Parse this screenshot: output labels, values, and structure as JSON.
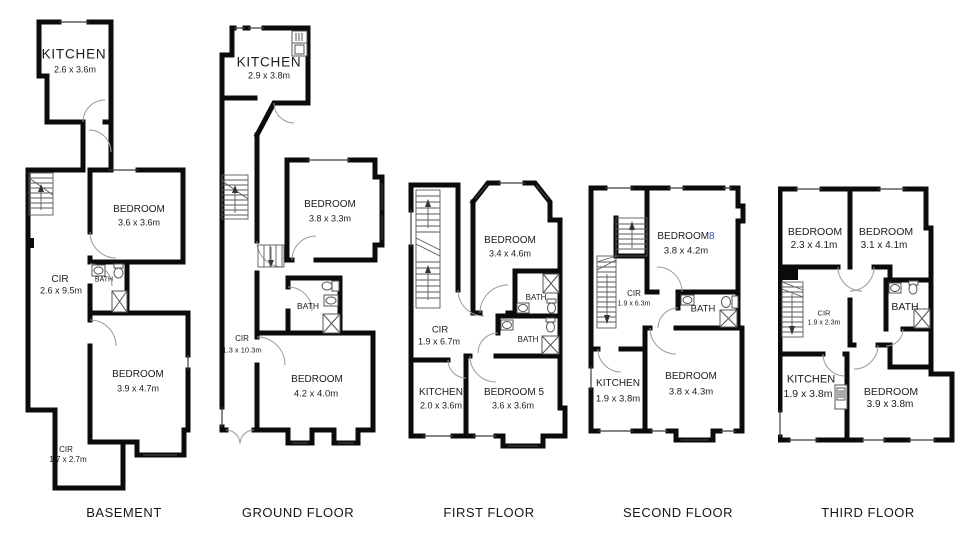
{
  "colors": {
    "wall": "#0b0b0b",
    "text": "#1c1c1e",
    "accent_number": "#3b52c3"
  },
  "floors": [
    {
      "caption": "BASEMENT",
      "rooms": [
        {
          "name": "KITCHEN",
          "dims": "2.6 x 3.6m"
        },
        {
          "name": "BEDROOM",
          "dims": "3.6 x 3.6m"
        },
        {
          "name": "CIR",
          "dims": "2.6 x 9.5m"
        },
        {
          "name": "BATH"
        },
        {
          "name": "BEDROOM",
          "dims": "3.9 x 4.7m"
        },
        {
          "name": "CIR",
          "dims": "1.7 x 2.7m"
        }
      ]
    },
    {
      "caption": "GROUND FLOOR",
      "rooms": [
        {
          "name": "KITCHEN",
          "dims": "2.9 x 3.8m"
        },
        {
          "name": "BEDROOM",
          "dims": "3.8 x 3.3m"
        },
        {
          "name": "BATH"
        },
        {
          "name": "CIR",
          "dims": "1.3 x 10.3m"
        },
        {
          "name": "BEDROOM",
          "dims": "4.2 x 4.0m"
        }
      ]
    },
    {
      "caption": "FIRST FLOOR",
      "rooms": [
        {
          "name": "BEDROOM",
          "dims": "3.4 x 4.6m"
        },
        {
          "name": "BATH"
        },
        {
          "name": "BATH"
        },
        {
          "name": "CIR",
          "dims": "1.9 x 6.7m"
        },
        {
          "name": "KITCHEN",
          "dims": "2.0 x 3.6m"
        },
        {
          "name": "BEDROOM 5",
          "dims": "3.6 x 3.6m"
        }
      ]
    },
    {
      "caption": "SECOND FLOOR",
      "rooms": [
        {
          "name": "BEDROOM",
          "suffix": "8",
          "dims": "3.8 x 4.2m"
        },
        {
          "name": "CIR",
          "dims": "1.9 x 6.3m"
        },
        {
          "name": "BATH"
        },
        {
          "name": "KITCHEN",
          "dims": "1.9 x 3.8m"
        },
        {
          "name": "BEDROOM",
          "dims": "3.8 x 4.3m"
        }
      ]
    },
    {
      "caption": "THIRD FLOOR",
      "rooms": [
        {
          "name": "BEDROOM",
          "dims": "2.3 x 4.1m"
        },
        {
          "name": "BEDROOM",
          "dims": "3.1 x 4.1m"
        },
        {
          "name": "CIR",
          "dims": "1.9 x 2.3m"
        },
        {
          "name": "BATH"
        },
        {
          "name": "KITCHEN",
          "dims": "1.9 x 3.8m"
        },
        {
          "name": "BEDROOM",
          "dims": "3.9 x 3.8m"
        }
      ]
    }
  ]
}
